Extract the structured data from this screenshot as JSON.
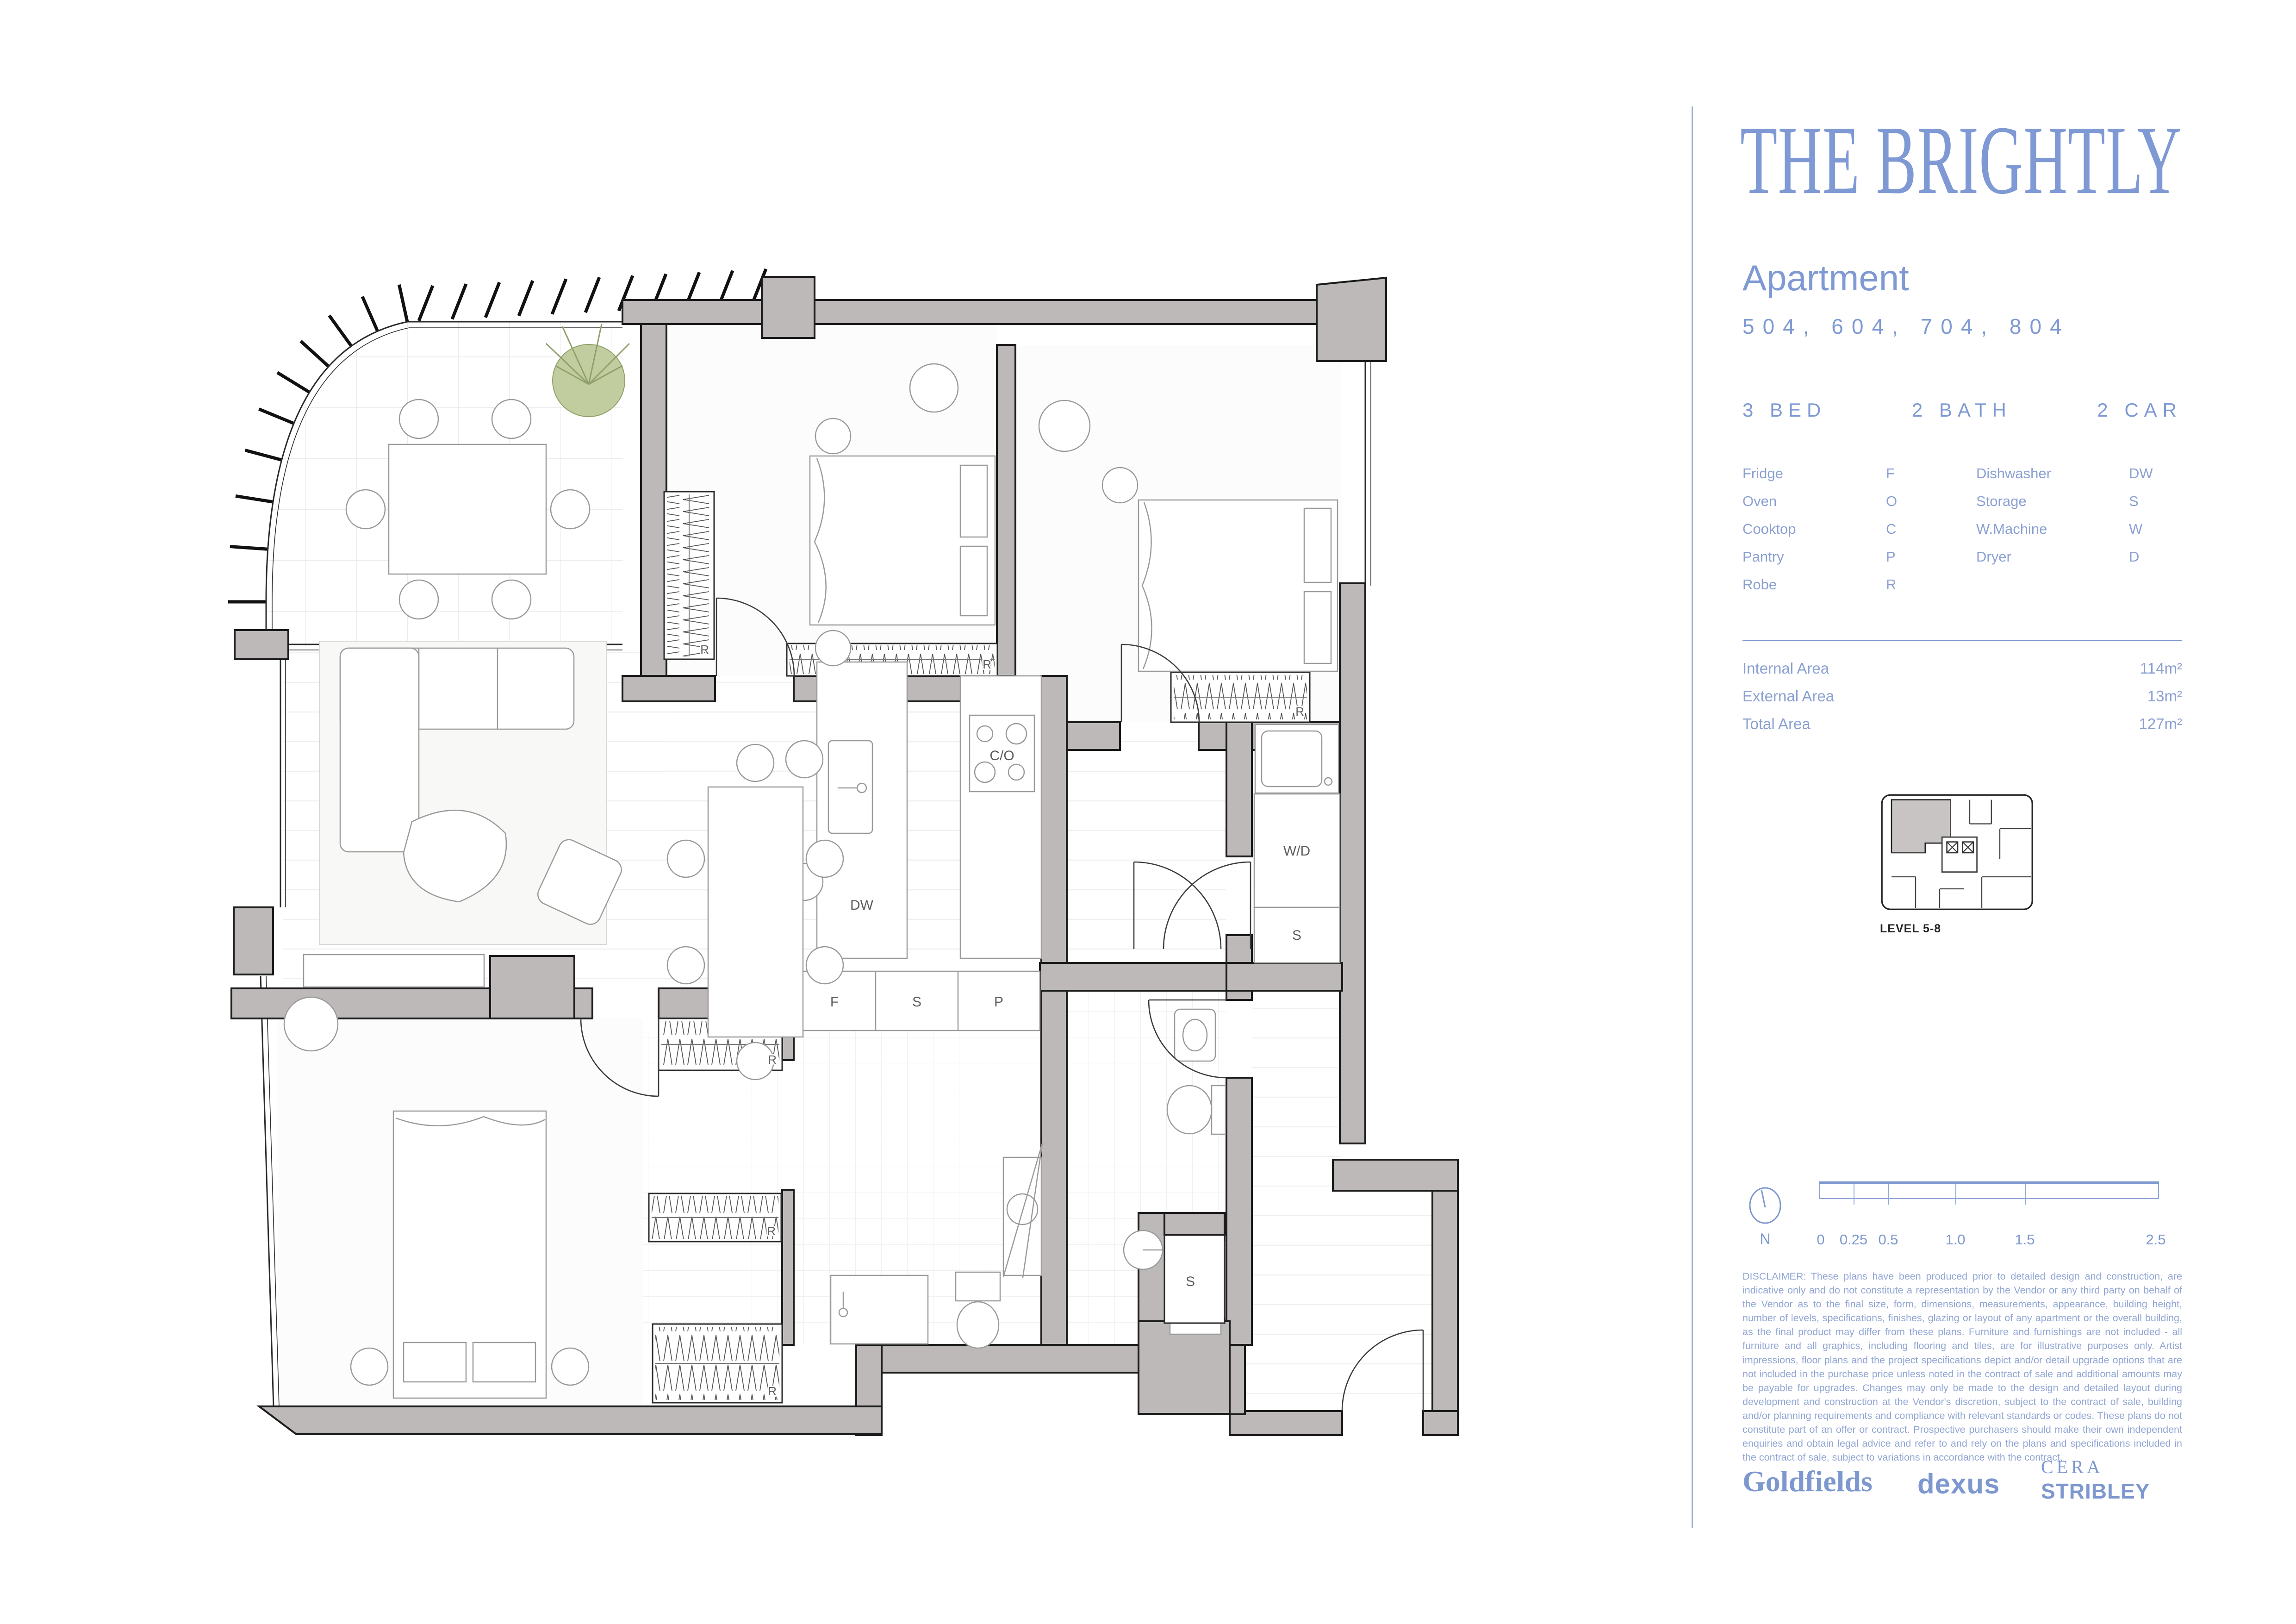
{
  "brand": {
    "title": "THE BRIGHTLY"
  },
  "apartment": {
    "heading": "Apartment",
    "numbers": "504, 604, 704, 804",
    "specs": {
      "bed": "3 BED",
      "bath": "2 BATH",
      "car": "2 CAR"
    }
  },
  "legend": {
    "left": [
      {
        "label": "Fridge",
        "code": "F"
      },
      {
        "label": "Oven",
        "code": "O"
      },
      {
        "label": "Cooktop",
        "code": "C"
      },
      {
        "label": "Pantry",
        "code": "P"
      },
      {
        "label": "Robe",
        "code": "R"
      }
    ],
    "right": [
      {
        "label": "Dishwasher",
        "code": "DW"
      },
      {
        "label": "Storage",
        "code": "S"
      },
      {
        "label": "W.Machine",
        "code": "W"
      },
      {
        "label": "Dryer",
        "code": "D"
      }
    ]
  },
  "areas": [
    {
      "label": "Internal Area",
      "value": "114m²"
    },
    {
      "label": "External Area",
      "value": "13m²"
    },
    {
      "label": "Total Area",
      "value": "127m²"
    }
  ],
  "keyplan": {
    "caption": "LEVEL 5-8"
  },
  "compass": {
    "label": "N"
  },
  "scalebar": {
    "ticks": [
      "0",
      "0.25",
      "0.5",
      "1.0",
      "1.5",
      "2.5"
    ]
  },
  "disclaimer": "DISCLAIMER: These plans have been produced prior to detailed design and construction, are indicative only and do not constitute a representation by the Vendor or any third party on behalf of the Vendor as to the final size, form, dimensions, measurements, appearance, building height, number of levels, specifications, finishes, glazing  or layout of any apartment or the overall building, as the final product may differ from these plans. Furniture and furnishings are not included - all furniture and all graphics, including flooring and tiles, are for illustrative purposes only. Artist impressions, floor plans and the project specifications depict and/or detail upgrade options that are not included in the purchase price unless noted in the contract of sale and additional amounts may be payable for upgrades. Changes may only be made to the design and detailed layout during development and construction at the Vendor's discretion, subject to the contract of sale, building and/or planning requirements and compliance with relevant standards or codes. These plans do not constitute part of an offer or contract. Prospective purchasers should make their own independent enquiries and obtain legal advice and refer to and rely on the plans and specifications included in the contract of sale, subject to variations in accordance with the contract.",
  "logos": {
    "goldfields": "Goldfields",
    "dexus": "dexus",
    "cera": "CERA",
    "stribley": "STRIBLEY"
  },
  "plan": {
    "labels": {
      "robe_bed2_wall": "R",
      "robe_bed2": "R",
      "robe_bed3": "R",
      "robe_master_top": "R",
      "robe_master_mid": "R",
      "robe_master_bottom": "R",
      "dishwasher": "DW",
      "cooktop_oven": "C/O",
      "fridge": "F",
      "storage_kitchen": "S",
      "pantry": "P",
      "washer_dryer": "W/D",
      "storage_laundry": "S",
      "storage_entry": "S"
    }
  }
}
